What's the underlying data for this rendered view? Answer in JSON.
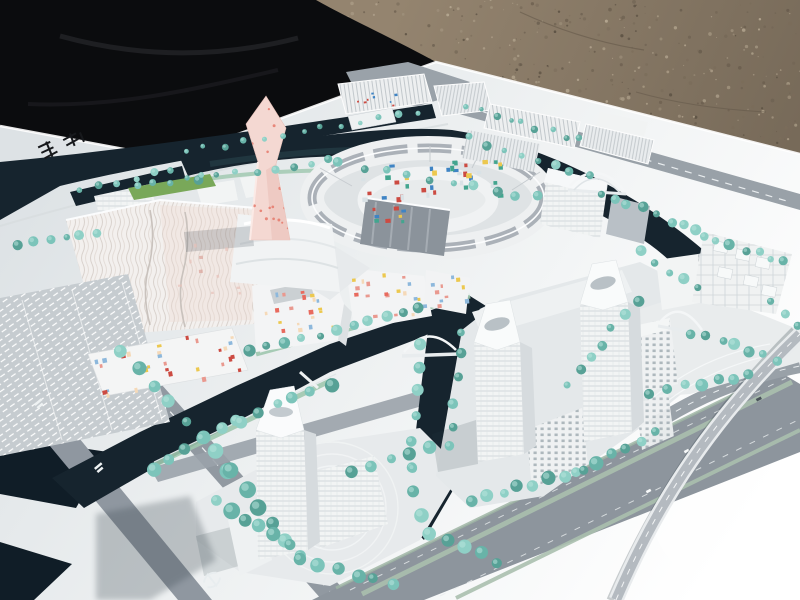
{
  "meta": {
    "description": "Outdoor photograph of a large white architectural scale model of a waterfront city master plan, viewed from an elevated oblique angle; the model board sits on gravel ground partly covered by a black tarp",
    "setting": "white model board, dark canals, teal model trees, gray roads, white buildings"
  },
  "groups": {
    "gravel": "gravel ground",
    "tarp": "black tarp cover",
    "board": "white model base board",
    "water": "dark canal network",
    "roads": "gray road network with pale green medians",
    "pink_tower": "twisting pink landmark tower with red dot facade",
    "ring": "elliptical ring building complex with gray roofs and colored mosaic inner band",
    "mosaic_district": "low-rise blocks with scattered colored window tiles",
    "west_complex": "large white-pink block complex with wavy facade",
    "south_tower": "tall white tower with tapered crown on plaza island",
    "twin_towers": "pair of tall white grid-facade towers with slab blocks",
    "north_slabs": "long louvered slab buildings along the north canal",
    "cube_cluster": "dense cluster of small white cubic blocks, east district",
    "bridges": "white arched pedestrian bridges over the canals",
    "trees": "teal foam model trees",
    "ramp": "curved elevated road ramp at the south-east interchange",
    "board_stamp": "small dark logo stamp printed on board, top-left",
    "road_stamp": "small light logo stamp printed on road, bottom-left",
    "street_labels": "tiny illegible white street-name markings on edge road",
    "shadow": "shadow cast across the board, lower left"
  },
  "palette": {
    "gravel_base": "#8d7e6a",
    "gravel_dark": "#6f6252",
    "gravel_light": "#a89a84",
    "tarp": "#0b0c0e",
    "board_light": "#dde2e5",
    "board_bright": "#ffffff",
    "water": "#16242e",
    "road": "#9199a1",
    "road_median": "#aabfae",
    "building_white": "#f2f4f4",
    "building_shade": "#d6dbde",
    "roof_gray": "#a6adb4",
    "pink": "#f4d8d2",
    "pink_dot": "#e5796b",
    "mosaic_red": "#cc4b42",
    "mosaic_blue": "#3f84c4",
    "mosaic_teal": "#43a58f",
    "mosaic_yellow": "#ecc84f",
    "tree": "#7cc4ba",
    "tree_dark": "#57a196",
    "tree_light": "#b8e4dc",
    "grass": "#79a859"
  },
  "speckles": {
    "count": 520,
    "xmin": 300,
    "xmax": 800,
    "ymin": 0,
    "ymax": 165,
    "colors": [
      "#6f6252",
      "#a89a84",
      "#5d5244",
      "#b3a58f",
      "#7a6c5a"
    ]
  },
  "trees": {
    "colors": [
      "#7cc4ba",
      "#68b3a8",
      "#8fd0c6",
      "#57a196"
    ],
    "highlight": "#b8e4dc",
    "rows": [
      [
        186,
        152,
        420,
        112,
        13,
        3
      ],
      [
        200,
        178,
        330,
        160,
        8,
        3.6
      ],
      [
        340,
        164,
        540,
        198,
        10,
        4
      ],
      [
        470,
        138,
        588,
        176,
        8,
        3.6
      ],
      [
        600,
        192,
        698,
        232,
        8,
        4.2
      ],
      [
        702,
        238,
        786,
        262,
        7,
        4.2
      ],
      [
        468,
        106,
        578,
        140,
        9,
        2.8
      ],
      [
        640,
        252,
        698,
        290,
        5,
        4.2
      ],
      [
        692,
        332,
        778,
        360,
        7,
        4.6
      ],
      [
        652,
        392,
        748,
        374,
        7,
        5
      ],
      [
        772,
        302,
        798,
        328,
        3,
        4.2
      ],
      [
        636,
        302,
        568,
        386,
        7,
        4.6
      ],
      [
        472,
        500,
        578,
        472,
        8,
        5.4
      ],
      [
        582,
        470,
        658,
        432,
        6,
        5.4
      ],
      [
        462,
        332,
        450,
        448,
        6,
        4.6
      ],
      [
        420,
        342,
        410,
        468,
        6,
        5
      ],
      [
        410,
        470,
        428,
        536,
        4,
        5.6
      ],
      [
        252,
        352,
        418,
        310,
        11,
        4.6
      ],
      [
        152,
        468,
        238,
        420,
        6,
        6
      ],
      [
        240,
        420,
        330,
        384,
        6,
        5.6
      ],
      [
        82,
        192,
        172,
        168,
        6,
        3.2
      ],
      [
        18,
        244,
        96,
        232,
        6,
        4
      ],
      [
        122,
        352,
        230,
        470,
        8,
        6
      ],
      [
        232,
        472,
        298,
        556,
        6,
        6.6
      ],
      [
        216,
        502,
        288,
        544,
        6,
        6.4
      ],
      [
        302,
        560,
        394,
        584,
        6,
        6
      ],
      [
        352,
        470,
        428,
        446,
        5,
        5.6
      ],
      [
        432,
        532,
        498,
        562,
        5,
        5.6
      ],
      [
        136,
        188,
        204,
        176,
        5,
        2.8
      ]
    ]
  },
  "mosaics": {
    "regions": [
      {
        "id": "ring-band",
        "x": 356,
        "y": 162,
        "w": 144,
        "h": 36,
        "rot": -3,
        "n": 40,
        "size": 4.2,
        "shape": "square",
        "colors": [
          "#3f84c4",
          "#cc4b42",
          "#43a58f",
          "#ecc84f",
          "#d9e2e6"
        ]
      },
      {
        "id": "ring-band-low",
        "x": 368,
        "y": 206,
        "w": 44,
        "h": 16,
        "rot": -3,
        "n": 8,
        "size": 4,
        "shape": "square",
        "colors": [
          "#3f84c4",
          "#cc4b42",
          "#43a58f",
          "#ecc84f"
        ]
      },
      {
        "id": "m1-tiles",
        "x": 256,
        "y": 288,
        "w": 76,
        "h": 44,
        "rot": -7,
        "n": 20,
        "size": 3.4,
        "shape": "square",
        "colors": [
          "#e9998f",
          "#ecc84f",
          "#8db8dc",
          "#e86a5e",
          "#f5d9b8"
        ]
      },
      {
        "id": "m2-tiles",
        "x": 350,
        "y": 272,
        "w": 74,
        "h": 44,
        "rot": -5,
        "n": 20,
        "size": 3.4,
        "shape": "square",
        "colors": [
          "#e9998f",
          "#ecc84f",
          "#8db8dc",
          "#e86a5e",
          "#f5d9b8"
        ]
      },
      {
        "id": "m3-tiles",
        "x": 96,
        "y": 340,
        "w": 140,
        "h": 44,
        "rot": -11,
        "n": 30,
        "size": 3.6,
        "shape": "square",
        "colors": [
          "#e9998f",
          "#ecc84f",
          "#8db8dc",
          "#cc4b42",
          "#f5d9b8"
        ]
      },
      {
        "id": "m4-tiles",
        "x": 426,
        "y": 272,
        "w": 40,
        "h": 32,
        "rot": -5,
        "n": 10,
        "size": 3.2,
        "shape": "square",
        "colors": [
          "#e9998f",
          "#ecc84f",
          "#8db8dc"
        ]
      },
      {
        "id": "slab-dots",
        "x": 348,
        "y": 86,
        "w": 72,
        "h": 20,
        "rot": -7,
        "n": 8,
        "size": 2.2,
        "shape": "square",
        "colors": [
          "#cc4b42",
          "#3f84c4"
        ]
      },
      {
        "id": "pink-dots",
        "x": 246,
        "y": 98,
        "w": 42,
        "h": 136,
        "rot": 0,
        "n": 32,
        "size": 2.4,
        "shape": "dot",
        "colors": [
          "#e5796b"
        ],
        "clip": "ptClip",
        "opacity": 0.85
      },
      {
        "id": "west-tint-dots",
        "x": 170,
        "y": 230,
        "w": 70,
        "h": 70,
        "rot": -5,
        "n": 10,
        "size": 3,
        "shape": "square",
        "colors": [
          "#e8c2ba",
          "#dba39a"
        ],
        "opacity": 0.7
      }
    ]
  },
  "markings": {
    "street_labels": [
      {
        "x": 34,
        "y": 404,
        "rot": -40
      },
      {
        "x": 94,
        "y": 468,
        "rot": -40
      }
    ],
    "board_stamp": {
      "x": 64,
      "y": 144,
      "rot": -12,
      "color": "#17191c"
    },
    "road_stamp": {
      "x": 212,
      "y": 580,
      "rot": -38,
      "color": "#e8edef"
    }
  }
}
